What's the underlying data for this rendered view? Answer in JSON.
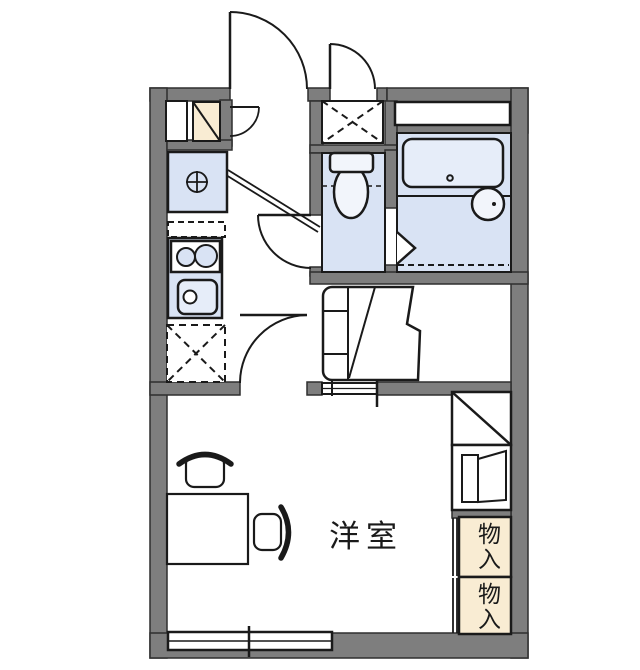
{
  "floorplan": {
    "labels": {
      "western_room": "洋室",
      "storage_top": "物入",
      "storage_bottom": "物入"
    },
    "colors": {
      "wall_gray": "#7e7e7e",
      "wet_area_blue": "#d9e3f4",
      "fixture_light_blue": "#e6edf9",
      "fixture_white_blue": "#f2f5fb",
      "storage_cream": "#f9ecd3",
      "line_black": "#1a1a1a",
      "background": "#ffffff"
    }
  }
}
